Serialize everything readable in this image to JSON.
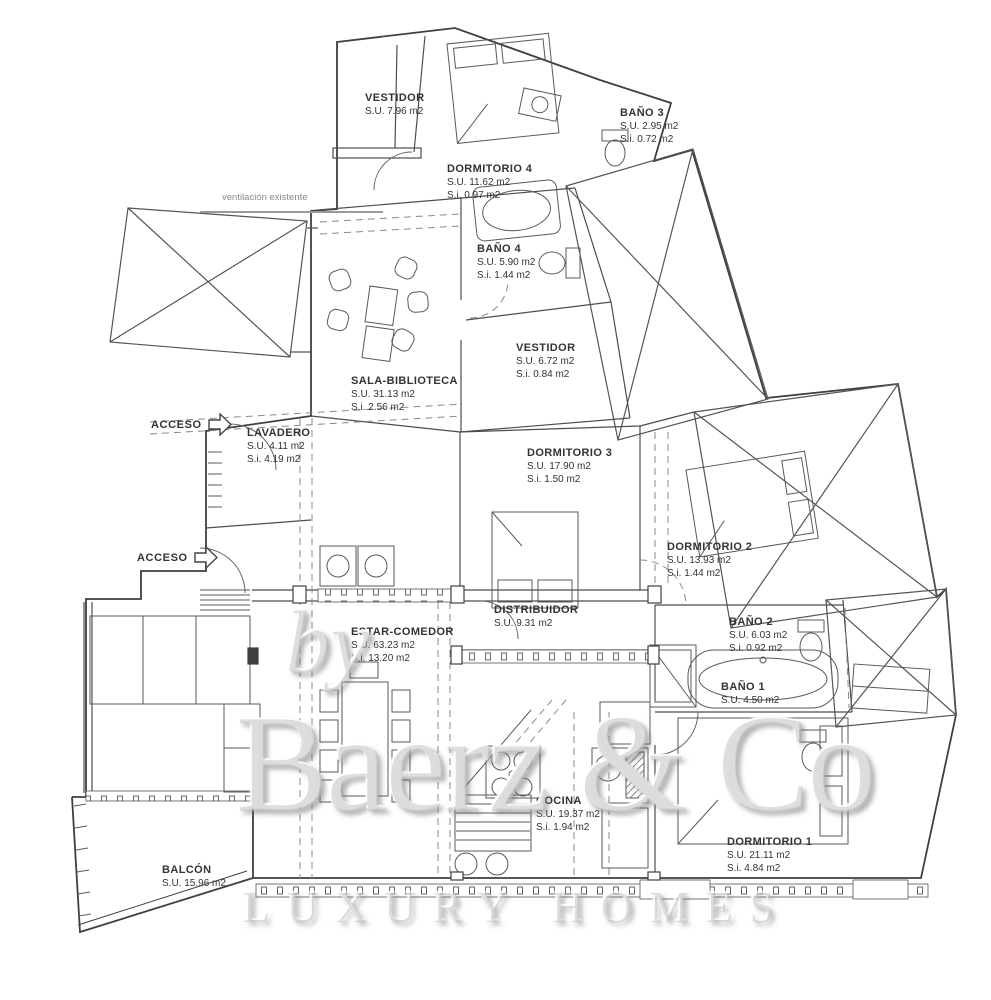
{
  "colors": {
    "wall": "#3f3f3f",
    "interior": "#4d4d4d",
    "furniture": "#5a5a5a",
    "dashed": "#8a8a8a",
    "label_text": "#333333",
    "muted_text": "#8a8a8a",
    "watermark_gray": "#c3c3c3"
  },
  "rooms": [
    {
      "id": "vestidor-top",
      "name": "VESTIDOR",
      "su": "S.U. 7.96 m2"
    },
    {
      "id": "dormitorio-4",
      "name": "DORMITORIO 4",
      "su": "S.U. 11.62 m2",
      "si": "S.i. 0.97 m2"
    },
    {
      "id": "bano-3",
      "name": "BAÑO 3",
      "su": "S.U. 2.95 m2",
      "si": "S.i. 0.72 m2"
    },
    {
      "id": "bano-4",
      "name": "BAÑO 4",
      "su": "S.U. 5.90 m2",
      "si": "S.i. 1.44 m2"
    },
    {
      "id": "vestidor-mid",
      "name": "VESTIDOR",
      "su": "S.U. 6.72 m2",
      "si": "S.i. 0.84 m2"
    },
    {
      "id": "sala-biblioteca",
      "name": "SALA-BIBLIOTECA",
      "su": "S.U. 31.13 m2",
      "si": "S.i. 2.56 m2"
    },
    {
      "id": "lavadero",
      "name": "LAVADERO",
      "su": "S.U. 4.11 m2",
      "si": "S.i. 4.19 m2"
    },
    {
      "id": "dormitorio-3",
      "name": "DORMITORIO 3",
      "su": "S.U. 17.90 m2",
      "si": "S.i. 1.50 m2"
    },
    {
      "id": "dormitorio-2",
      "name": "DORMITORIO 2",
      "su": "S.U. 13.93 m2",
      "si": "S.i. 1.44 m2"
    },
    {
      "id": "distribuidor",
      "name": "DISTRIBUIDOR",
      "su": "S.U. 9.31 m2"
    },
    {
      "id": "bano-2",
      "name": "BAÑO 2",
      "su": "S.U. 6.03 m2",
      "si": "S.i. 0.92 m2"
    },
    {
      "id": "bano-1",
      "name": "BAÑO 1",
      "su": "S.U. 4.50 m2"
    },
    {
      "id": "estar-comedor",
      "name": "ESTAR-COMEDOR",
      "su": "S.U. 63.23 m2",
      "si": "S.i. 13.20 m2"
    },
    {
      "id": "cocina",
      "name": "COCINA",
      "su": "S.U. 19.37 m2",
      "si": "S.i. 1.94 m2"
    },
    {
      "id": "dormitorio-1",
      "name": "DORMITORIO 1",
      "su": "S.U. 21.11 m2",
      "si": "S.i. 4.84 m2"
    },
    {
      "id": "balcon",
      "name": "BALCÓN",
      "su": "S.U. 15.96 m2"
    }
  ],
  "annotations": {
    "ventilacion": "ventilación existente",
    "acceso_top": "ACCESO",
    "acceso_mid": "ACCESO"
  },
  "watermark": {
    "by": "by",
    "brand": "Baerz & Co",
    "tagline": "LUXURY HOMES"
  }
}
